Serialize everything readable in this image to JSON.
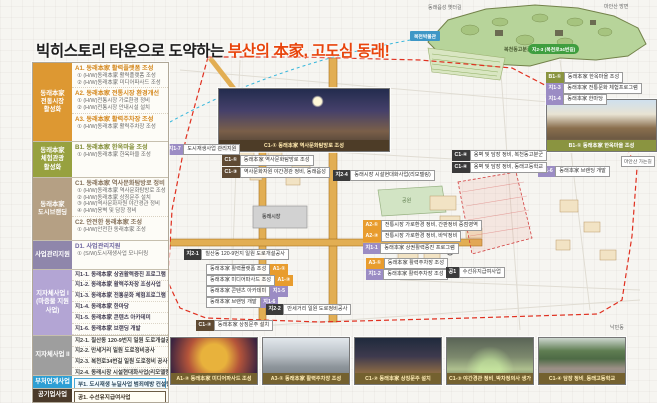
{
  "title": {
    "black": "빅히스토리 타운으로 도약하는 ",
    "red": "부산의 本家, 고도심 동래!"
  },
  "colors": {
    "accent_red": "#e8440c",
    "group_orange": "#dd9832",
    "group_olive": "#97a13f",
    "group_tan": "#b5a084",
    "group_purple": "#b3a5d4",
    "group_blue": "#2e9fd4",
    "chip_brown": "#5f4a33"
  },
  "legend": {
    "groups": [
      {
        "category": "동래本家\n전통시장\n활성화",
        "items": [
          {
            "h": "A1. 동래本家 활력플랫폼 조성",
            "subs": [
              "① (H/W)동래本家 활력플랫폼 조성",
              "② (H/W)동래本家 미디어파사드 조성"
            ]
          },
          {
            "h": "A2. 동래本家 전통시장 환경개선",
            "subs": [
              "① (H/W)전통시장 가로환경 정비",
              "② (H/W)전통시장 안내시설 설치"
            ]
          },
          {
            "h": "A3. 동래本家 활력주차장 조성",
            "subs": [
              "① (H/W)동래本家 활력주차장 조성"
            ]
          }
        ]
      },
      {
        "category": "동래本家\n체험관광\n활성화",
        "items": [
          {
            "h": "B1. 동래本家 한옥마을 조성",
            "subs": [
              "① (H/W)동래本家 한옥마을 조성"
            ]
          }
        ]
      },
      {
        "category": "동래本家\n도시브랜딩",
        "items": [
          {
            "h": "C1. 동래本家 역사문화탐방로 정비",
            "subs": [
              "① (H/W)동래本家 역사문화탐방로 조성",
              "② (H/W)동래本家 상징문주 설치",
              "③ (H/W)역사문화자원 야간경관 정비",
              "④ (H/W)옹벽 및 담장 정비"
            ]
          },
          {
            "h": "C2. 안전한 동래本家 조성",
            "subs": [
              "① (H/W)안전한 동래本家 조성"
            ]
          }
        ]
      },
      {
        "category": "사업관리지원",
        "items": [
          {
            "h": "D1. 사업관리지원",
            "subs": [
              "① (S/W)도시재생사업 모니터링"
            ]
          }
        ]
      },
      {
        "category": "지자체사업 I\n(마중물 지원사업)",
        "rows": [
          "지1-1. 동래本家 상권활력증진 프로그램",
          "지1-2. 동래本家 활력주차장 조성사업",
          "지1-3. 동래本家 전통문화 체험프로그램",
          "지1-4. 동래本家 한마당",
          "지1-5. 동래本家 콘텐츠 아카데미",
          "지1-6. 동래本家 브랜딩 개발",
          "지1-7. 도시재생사업 관리지원"
        ]
      },
      {
        "category": "지자체사업 II",
        "rows": [
          "지2-1. 칠산동 120-9번지 일원 도로개설공사",
          "지2-2. 만세거리 일원 도로정비공사",
          "지2-3. 복천로34번길 일원 도로정비 공사",
          "지2-4. 동래시장 시설현대화사업(리모델링)"
        ]
      },
      {
        "category": "부처연계사업",
        "rows": [
          "부1. 도시재생 뉴딜사업 범죄예방 컨설팅"
        ]
      },
      {
        "category": "공기업사업",
        "rows": [
          "공1. 수선유지급여사업"
        ]
      }
    ]
  },
  "map": {
    "chips": [
      {
        "code": "지1-7",
        "text": "도시재생사업 관리지원"
      },
      {
        "code": "C1-①",
        "text": "동래本家 역사문화탐방로 조성"
      },
      {
        "code": "C1-③",
        "text": "역사문화자원 야간경관 정비, 동래읍성"
      },
      {
        "code": "B1-①",
        "text": "동래本家 한옥마을 조성"
      },
      {
        "code": "지1-3",
        "text": "동래本家 전통문화 체험프로그램"
      },
      {
        "code": "지1-4",
        "text": "동래本家 한마당"
      },
      {
        "code": "지1-6",
        "text": "동래本家 브랜딩 개발"
      },
      {
        "code": "지2-4",
        "text": "동래시장 시설현대화사업(리모델링)"
      },
      {
        "code": "C1-④",
        "text": "옹벽 및 담장 정비, 복천동고분군"
      },
      {
        "code": "C1-④",
        "text": "옹벽 및 담장 정비, 동래고등학교"
      },
      {
        "code": "A2-①",
        "text": "전통시장 가로환경 정비, 간판정비 중점영역"
      },
      {
        "code": "A2-②",
        "text": "전통시장 가로환경 정비, 바닥정비"
      },
      {
        "code": "지1-1",
        "text": "동래本家 상권활력증진 프로그램"
      },
      {
        "code": "A3-①",
        "text": "동래本家 활력주차장 조성"
      },
      {
        "code": "지1-2",
        "text": "동래本家 활력주차장 조성"
      },
      {
        "code": "공1",
        "text": "수선유지급여사업"
      },
      {
        "code": "지2-1",
        "text": "칠산동 120-9번지 일원 도로개설공사"
      },
      {
        "code": "A1-①",
        "text": "동래本家 활력플랫폼 조성"
      },
      {
        "code": "A1-②",
        "text": "동래本家 미디어파사드 조성"
      },
      {
        "code": "지1-5",
        "text": "동래本家 콘텐츠 아카데미"
      },
      {
        "code": "지1-6",
        "text": "동래本家 브랜딩 개발"
      },
      {
        "code": "C1-②",
        "text": "동래本家 상징문주 설치"
      },
      {
        "code": "지2-2",
        "text": "만세거리 일원 도로정비공사"
      }
    ],
    "labels": {
      "market": "동래시장",
      "park": "공원",
      "tombs": "복천동고분군",
      "museum": "복천박물관",
      "road_pill": "지2-3 (복천로34번길)",
      "old_wall_path": "동래읍성 옛터길",
      "maansan": "마안산 방면",
      "maansan_way": "마안산 가는길",
      "nakmin": "낙민동"
    },
    "center_photo_caption": "C1-① 동래本家 역사문화탐방로 조성",
    "right_photo_caption": "B1-① 동래本家 한옥마을 조성"
  },
  "photos": {
    "bottom": [
      "A1-② 동래本家 미디어파사드 조성",
      "A3-① 동래本家 활력주차장 조성",
      "C1-② 동래本家 상징문주 설치",
      "C1-③ 야간경관 정비_박차정의사 생가",
      "C1-④ 담장 정비_동래고등학교"
    ]
  }
}
